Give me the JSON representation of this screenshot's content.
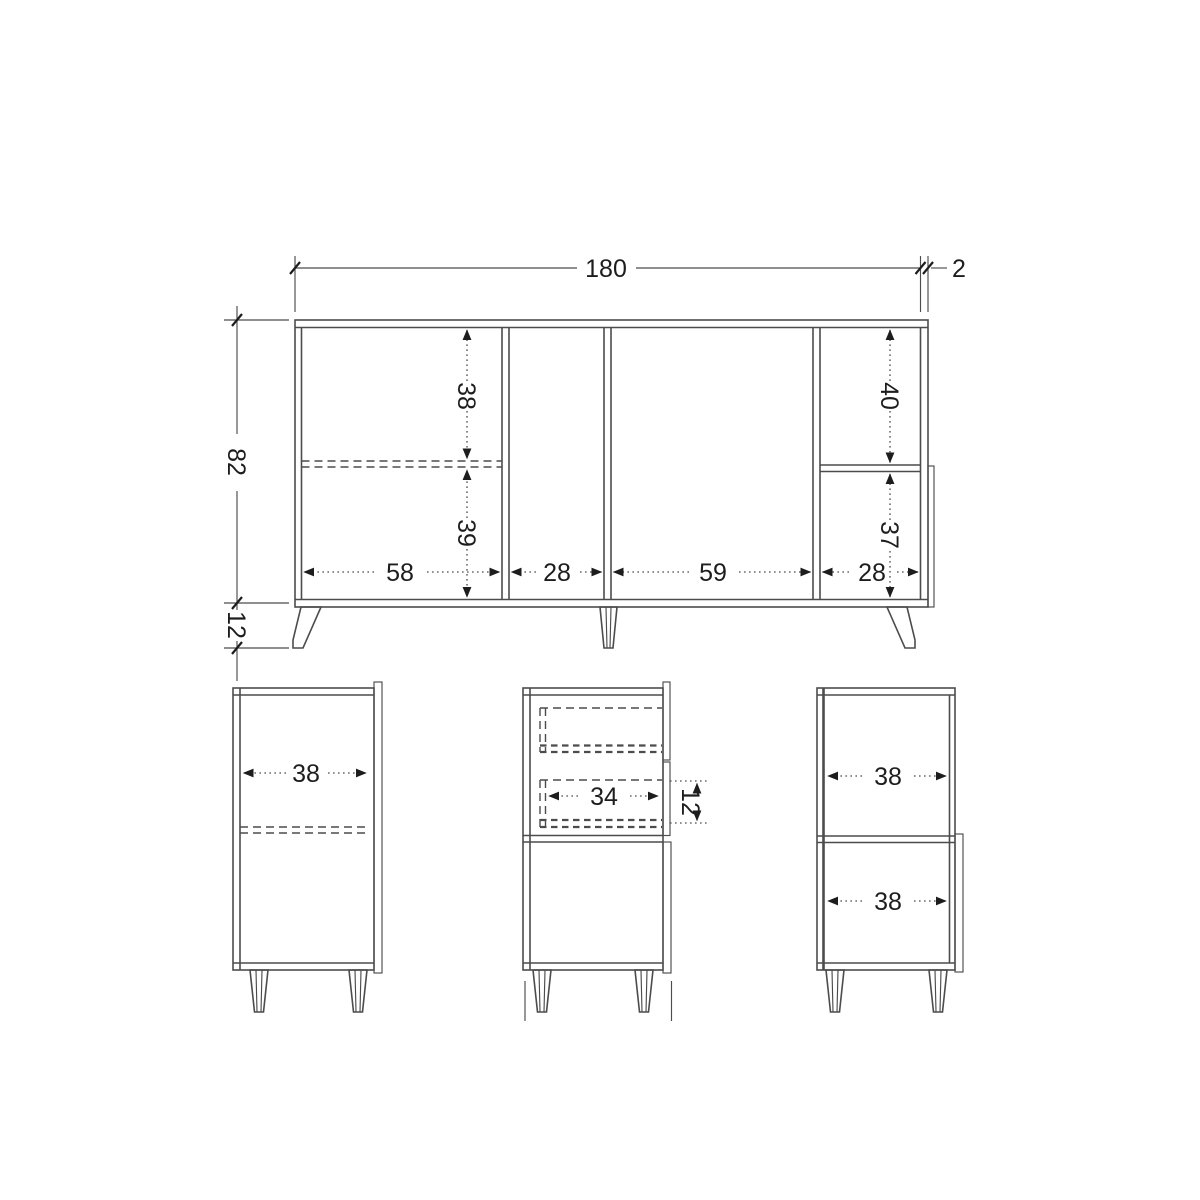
{
  "drawing_title": "cabinet-dimension-drawing",
  "colors": {
    "line": "#4c4c4c",
    "text": "#1d1d1d",
    "background": "#ffffff"
  },
  "front_view": {
    "overall_width": "180",
    "top_panel_thickness": "2",
    "body_height": "82",
    "leg_height": "12",
    "upper_left_inner_height": "38",
    "lower_left_inner_height": "39",
    "upper_right_inner_height": "40",
    "lower_right_inner_height": "37",
    "compartment_widths": [
      "58",
      "28",
      "59",
      "28"
    ]
  },
  "left_side_view": {
    "inner_depth": "38"
  },
  "middle_section_view": {
    "drawer_inner_width": "34",
    "drawer_inner_height": "12"
  },
  "right_side_view": {
    "upper_inner_depth": "38",
    "lower_inner_depth": "38"
  }
}
